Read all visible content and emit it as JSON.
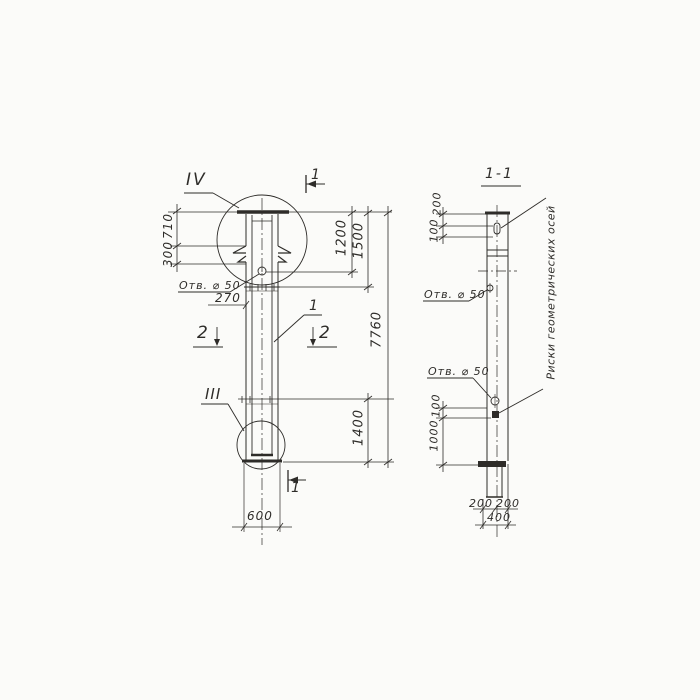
{
  "colors": {
    "ink": "#2e2c29",
    "bg": "#fbfbf9"
  },
  "left_view": {
    "detail_top_label": "IV",
    "detail_bottom_label": "III",
    "cut_top_label": "1",
    "cut_bottom_label": "1",
    "cut2_left_label": "2",
    "cut2_right_label": "2",
    "part_label": "1",
    "hole_label": "Отв. ⌀ 50",
    "dims": {
      "d710": "710",
      "d300": "300",
      "d1200": "1200",
      "d1500": "1500",
      "d7760": "7760",
      "d1400": "1400",
      "d600": "600",
      "d270": "270"
    }
  },
  "right_view": {
    "title": "1-1",
    "hole_label_upper": "Отв. ⌀ 50",
    "hole_label_lower": "Отв. ⌀ 50",
    "axis_note": "Риски геометрических осей",
    "dims": {
      "d200_top": "200",
      "d100_top": "100",
      "d100_bottom": "100",
      "d1000": "1000",
      "d200_bl": "200",
      "d200_br": "200",
      "d400": "400"
    }
  }
}
